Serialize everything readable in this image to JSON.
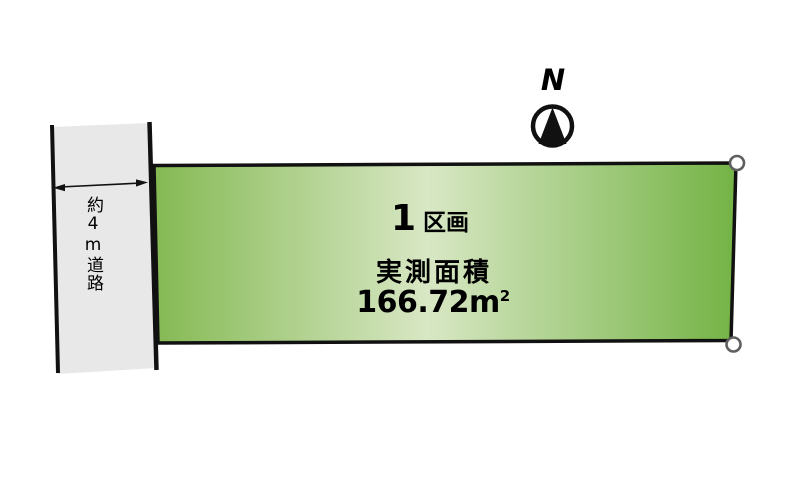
{
  "compass": {
    "label": "N"
  },
  "road": {
    "label": "約4m道路"
  },
  "plot": {
    "number": "1",
    "number_suffix": "区画",
    "area_label": "実測面積",
    "area_value": "166.72m",
    "area_superscript": "2"
  },
  "colors": {
    "background": "#ffffff",
    "road_fill": "#e8e8e8",
    "line_color": "#111111",
    "plot_green_edge_left": "#84b953",
    "plot_green_light": "#d8e7c4",
    "plot_green_edge_right": "#74b345",
    "marker_stroke": "#5f5f5f",
    "text_color": "#000000"
  }
}
